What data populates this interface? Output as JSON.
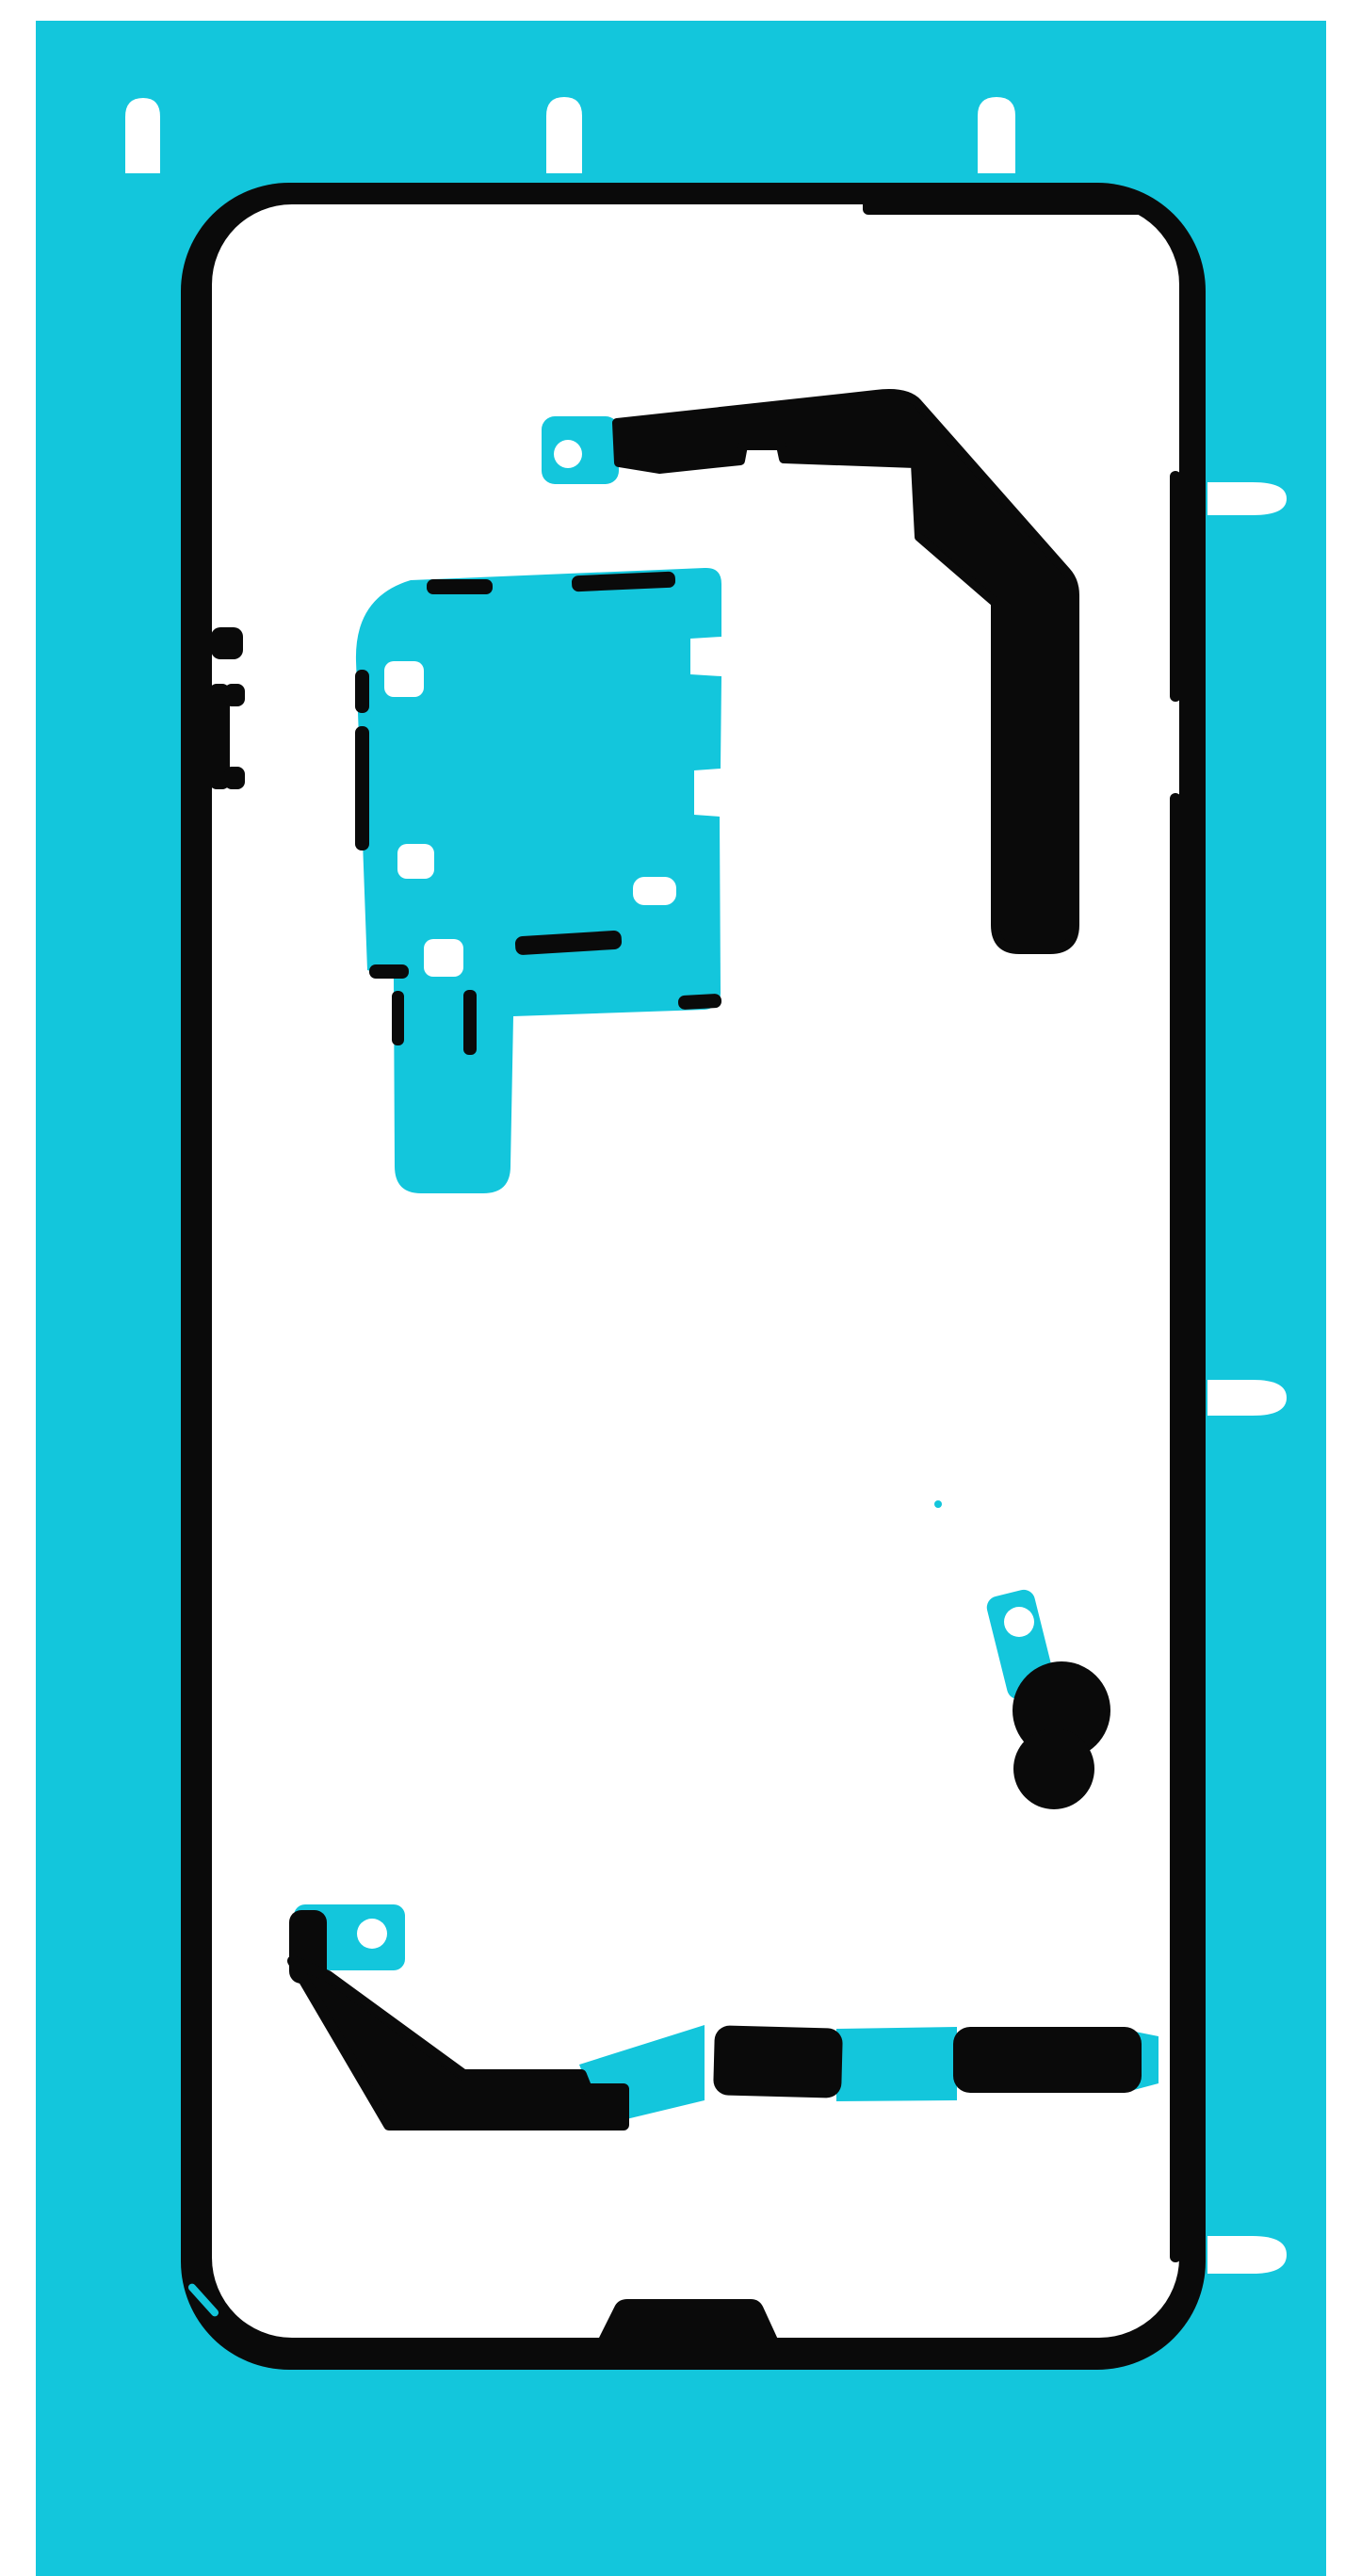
{
  "document": {
    "title": "Back cover adhesive foil sheet",
    "description": "Scan of a die-cut adhesive liner sheet for a smartphone back cover: cyan carrier sheet, black adhesive strips arranged along a phone-shaped outline, white die-cut holes and release tabs"
  },
  "colors": {
    "page_white": "#ffffff",
    "sheet_cyan": "#13c6dc",
    "adhesive_black": "#0a0a0a",
    "cutout_white": "#ffffff"
  },
  "sheet": {
    "aria_label": "Adhesive foil sheet for phone back cover",
    "top_alignment_tab_count": "3",
    "right_release_tab_count": "3",
    "pull_tab_hole_count": "3",
    "pieces": [
      "phone-outline-frame",
      "top-right-adhesive-strip",
      "upper-left-adhesive-patch",
      "camera-area-adhesive-pad",
      "bottom-adhesive-strip"
    ]
  }
}
